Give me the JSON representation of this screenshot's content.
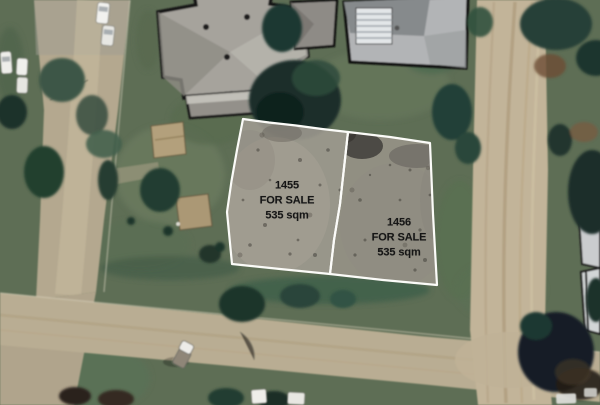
{
  "lots": [
    {
      "id": "1455",
      "status": "FOR SALE",
      "area": "535 sqm"
    },
    {
      "id": "1456",
      "status": "FOR SALE",
      "area": "535 sqm"
    }
  ],
  "palette": {
    "parcel_border": "#fbfbf8",
    "parcel_fill_1455": "#a19c92",
    "parcel_fill_1456": "#999489",
    "label_text": "#161616",
    "grass": "#5e6e55",
    "sealed_road": "#b4a88f",
    "dirt_road": "#c2b499",
    "tree_dark": "#1b2f2b",
    "roof_gray": "#a6a39c"
  }
}
